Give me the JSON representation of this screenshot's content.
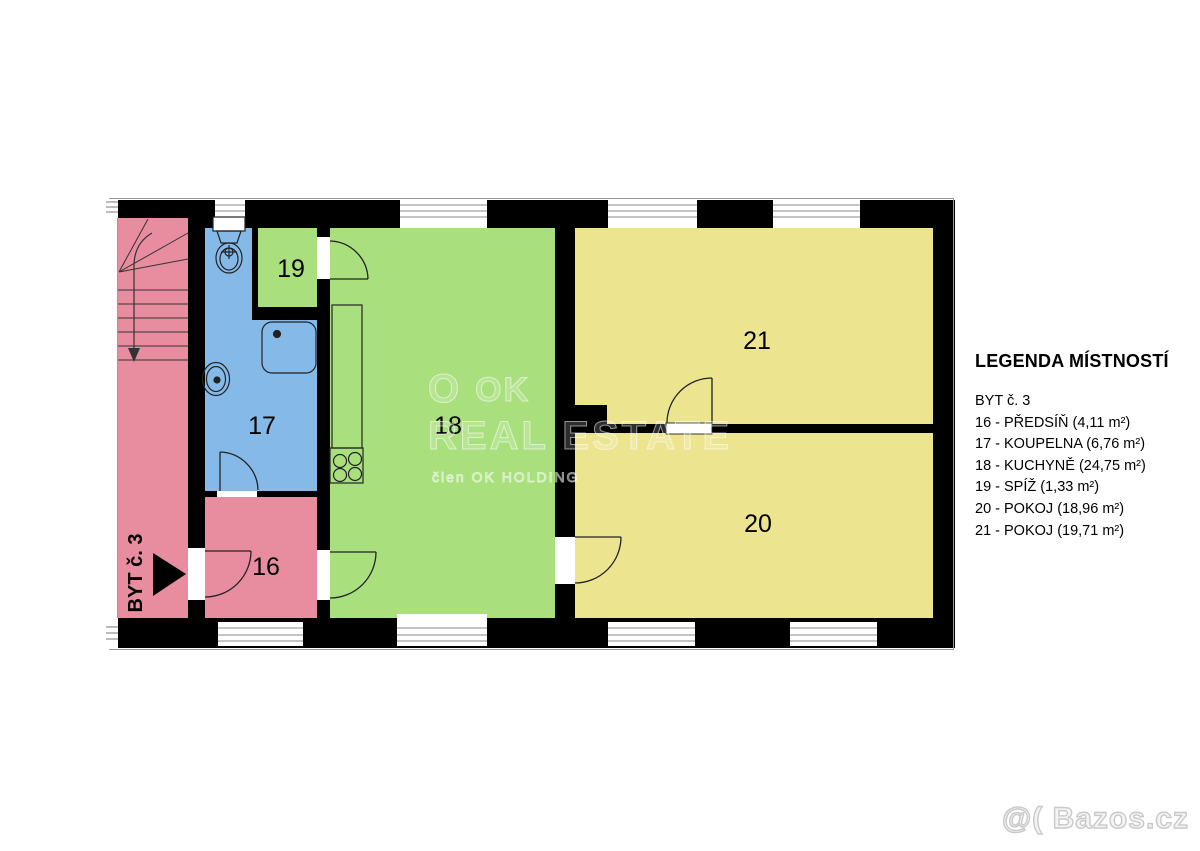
{
  "legend": {
    "title": "LEGENDA MÍSTNOSTÍ",
    "apartment": "BYT č. 3",
    "items": [
      "16 - PŘEDSÍŇ (4,11 m²)",
      "17 - KOUPELNA (6,76 m²)",
      "18 - KUCHYNĚ (24,75 m²)",
      "19 - SPÍŽ (1,33 m²)",
      "20 - POKOJ (18,96 m²)",
      "21 - POKOJ (19,71 m²)"
    ]
  },
  "plan": {
    "apartment_label": "BYT č. 3",
    "room_labels": {
      "r16": "16",
      "r17": "17",
      "r18": "18",
      "r19": "19",
      "r20": "20",
      "r21": "21"
    },
    "colors": {
      "hall": "#E88D9F",
      "bathroom": "#85BAE8",
      "kitchen": "#A9E07D",
      "room": "#ECE48F",
      "wall": "#000000"
    }
  },
  "watermark": {
    "logo": "O",
    "brand": "OK",
    "brand_line2": "REAL ESTATE",
    "tagline": "člen OK HOLDING"
  },
  "site_watermark": "@( Bazos.cz"
}
